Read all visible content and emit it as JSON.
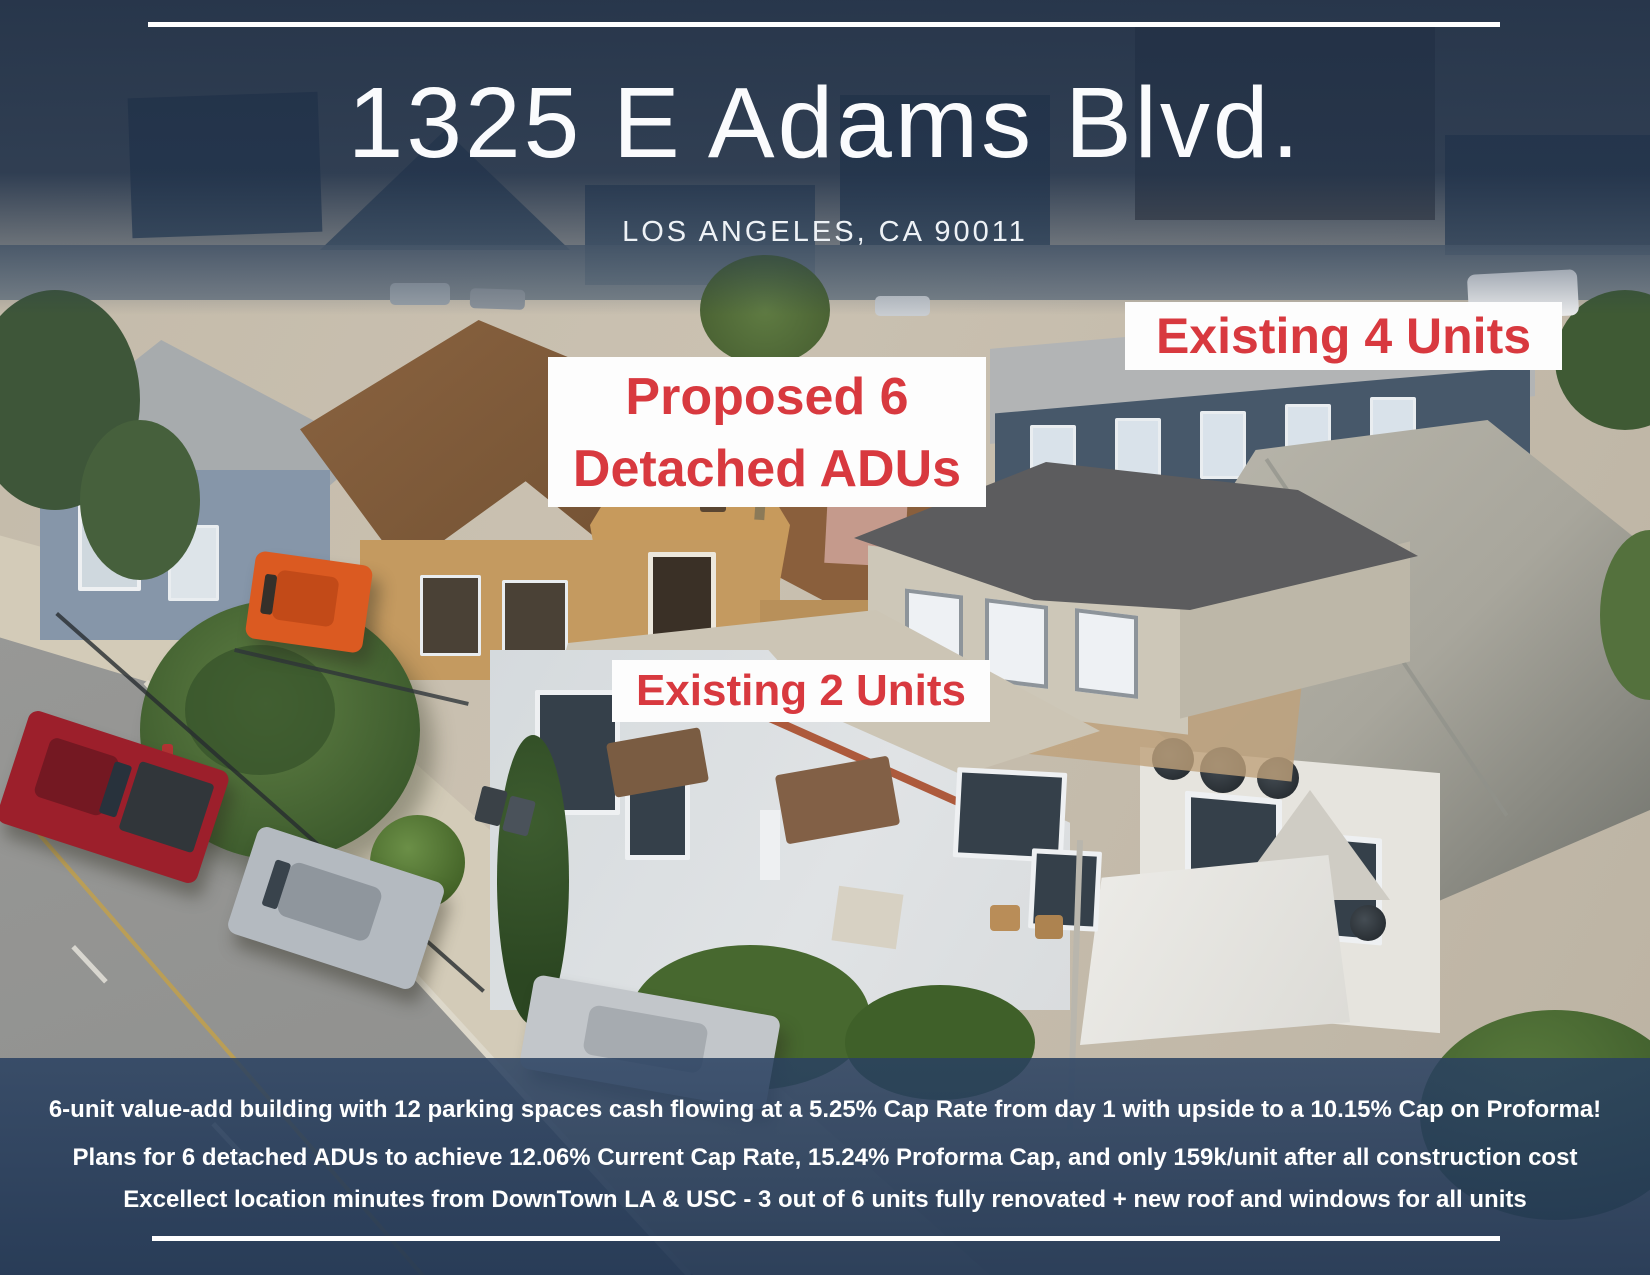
{
  "header": {
    "title": "1325 E Adams Blvd.",
    "subtitle": "LOS ANGELES, CA 90011"
  },
  "labels": {
    "proposed_line1": "Proposed 6",
    "proposed_line2": "Detached ADUs",
    "existing4": "Existing 4 Units",
    "existing2": "Existing 2 Units"
  },
  "footer": {
    "line1": "6-unit value-add building with 12 parking spaces cash flowing at a 5.25% Cap Rate from day 1 with upside to a 10.15% Cap on Proforma!",
    "line2": "Plans for 6 detached ADUs to achieve 12.06% Current Cap Rate, 15.24% Proforma Cap, and only 159k/unit after all construction cost",
    "line3": "Excellect location minutes from DownTown LA & USC - 3 out of 6 units fully renovated + new roof and windows for all units"
  },
  "colors": {
    "accent_red": "#d8393f",
    "overlay_navy": "#2a4166",
    "divider_white": "#ffffff",
    "label_background": "#fdfdfd"
  }
}
